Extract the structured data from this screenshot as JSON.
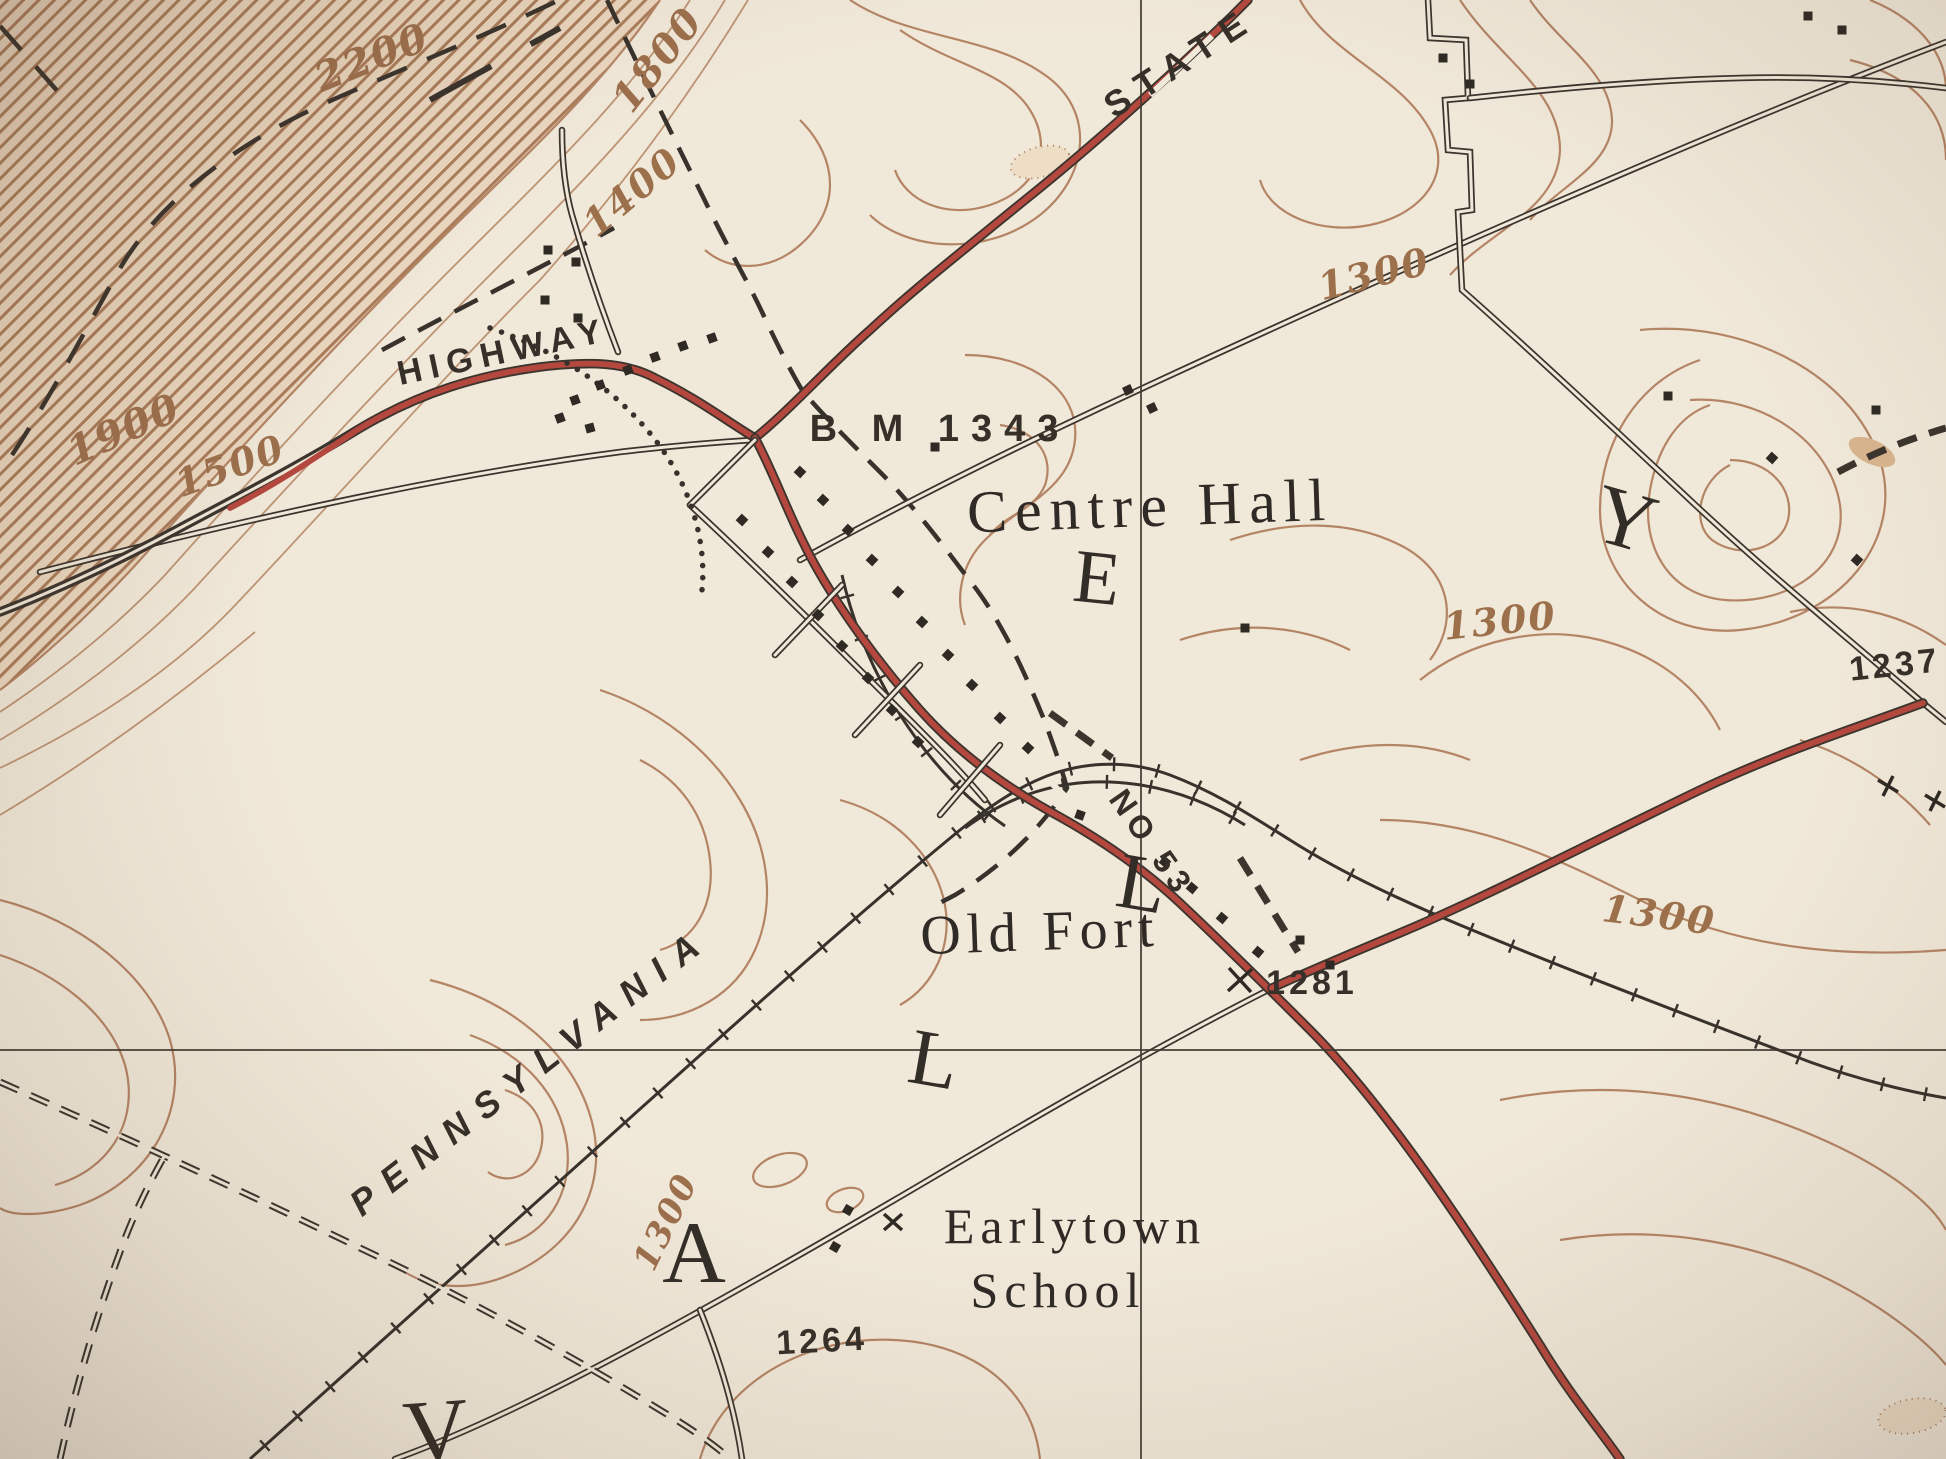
{
  "map": {
    "kind": "topographic-map-photo",
    "spread_word": "VALLEY",
    "colors": {
      "paper": "#f2ebdd",
      "contour_brown": "#b28263",
      "road_red": "#b2423a",
      "ink_black": "#2f2b27",
      "label_brown": "#9a6c49"
    },
    "labels": [
      {
        "id": "label-state",
        "text": "STATE",
        "x": 1180,
        "y": 62,
        "rot": -33,
        "size": 36,
        "ls": 12,
        "cls": "route"
      },
      {
        "id": "label-highway",
        "text": "HIGHWAY",
        "x": 503,
        "y": 352,
        "rot": -12,
        "size": 34,
        "ls": 8,
        "cls": "route"
      },
      {
        "id": "label-pennsylvania",
        "text": "PENNSYLVANIA",
        "x": 530,
        "y": 1071,
        "rot": -38,
        "size": 36,
        "ls": 14,
        "cls": "route",
        "italic": true
      },
      {
        "id": "label-no-53",
        "text": "NO 53",
        "x": 1152,
        "y": 843,
        "rot": 55,
        "size": 32,
        "ls": 6,
        "cls": "route"
      },
      {
        "id": "label-centre-hall",
        "text": "Centre Hall",
        "x": 1150,
        "y": 506,
        "rot": -2,
        "size": 60,
        "ls": 8,
        "cls": "place"
      },
      {
        "id": "label-old-fort",
        "text": "Old Fort",
        "x": 1040,
        "y": 932,
        "rot": -2,
        "size": 56,
        "ls": 6,
        "cls": "place"
      },
      {
        "id": "label-earlytown",
        "text": "Earlytown",
        "x": 1075,
        "y": 1226,
        "rot": 0,
        "size": 50,
        "ls": 6,
        "cls": "place"
      },
      {
        "id": "label-school",
        "text": "School",
        "x": 1058,
        "y": 1290,
        "rot": 0,
        "size": 50,
        "ls": 6,
        "cls": "place"
      },
      {
        "id": "label-bm-1343",
        "text": "B M 1343",
        "x": 940,
        "y": 429,
        "rot": 0,
        "size": 38,
        "ls": 12,
        "cls": "elev"
      },
      {
        "id": "label-1281",
        "text": "1281",
        "x": 1312,
        "y": 983,
        "rot": 0,
        "size": 34,
        "ls": 4,
        "cls": "elev"
      },
      {
        "id": "label-1264",
        "text": "1264",
        "x": 822,
        "y": 1341,
        "rot": -3,
        "size": 34,
        "ls": 4,
        "cls": "elev"
      },
      {
        "id": "label-1237",
        "text": "1237",
        "x": 1895,
        "y": 665,
        "rot": -6,
        "size": 34,
        "ls": 4,
        "cls": "elev"
      },
      {
        "id": "contour-2200",
        "text": "2200",
        "x": 372,
        "y": 58,
        "rot": -22,
        "size": 40,
        "ls": 2,
        "cls": "contourlbl"
      },
      {
        "id": "contour-1800",
        "text": "1800",
        "x": 658,
        "y": 60,
        "rot": -52,
        "size": 40,
        "ls": 2,
        "cls": "contourlbl"
      },
      {
        "id": "contour-1900",
        "text": "1900",
        "x": 124,
        "y": 430,
        "rot": -24,
        "size": 40,
        "ls": 2,
        "cls": "contourlbl"
      },
      {
        "id": "contour-1500",
        "text": "1500",
        "x": 230,
        "y": 466,
        "rot": -20,
        "size": 38,
        "ls": 2,
        "cls": "contourlbl"
      },
      {
        "id": "contour-1400",
        "text": "1400",
        "x": 632,
        "y": 192,
        "rot": -40,
        "size": 38,
        "ls": 2,
        "cls": "contourlbl"
      },
      {
        "id": "contour-1300-a",
        "text": "1300",
        "x": 1374,
        "y": 274,
        "rot": -14,
        "size": 38,
        "ls": 2,
        "cls": "contourlbl"
      },
      {
        "id": "contour-1300-b",
        "text": "1300",
        "x": 1500,
        "y": 621,
        "rot": -6,
        "size": 38,
        "ls": 2,
        "cls": "contourlbl"
      },
      {
        "id": "contour-1300-c",
        "text": "1300",
        "x": 1659,
        "y": 915,
        "rot": 7,
        "size": 38,
        "ls": 2,
        "cls": "contourlbl"
      },
      {
        "id": "contour-1300-d",
        "text": "1300",
        "x": 666,
        "y": 1222,
        "rot": -64,
        "size": 34,
        "ls": 2,
        "cls": "contourlbl"
      },
      {
        "id": "valley-letter-v",
        "text": "V",
        "x": 436,
        "y": 1432,
        "rot": -4,
        "size": 90,
        "ls": 0,
        "cls": "big"
      },
      {
        "id": "valley-letter-a",
        "text": "A",
        "x": 694,
        "y": 1254,
        "rot": 0,
        "size": 88,
        "ls": 0,
        "cls": "big"
      },
      {
        "id": "valley-letter-l1",
        "text": "L",
        "x": 934,
        "y": 1060,
        "rot": 10,
        "size": 80,
        "ls": 0,
        "cls": "big"
      },
      {
        "id": "valley-letter-l2",
        "text": "L",
        "x": 1142,
        "y": 884,
        "rot": 10,
        "size": 80,
        "ls": 0,
        "cls": "big"
      },
      {
        "id": "valley-letter-e",
        "text": "E",
        "x": 1097,
        "y": 578,
        "rot": 6,
        "size": 76,
        "ls": 0,
        "cls": "big"
      },
      {
        "id": "valley-letter-y",
        "text": "Y",
        "x": 1625,
        "y": 520,
        "rot": 16,
        "size": 84,
        "ls": 0,
        "cls": "big"
      }
    ]
  }
}
